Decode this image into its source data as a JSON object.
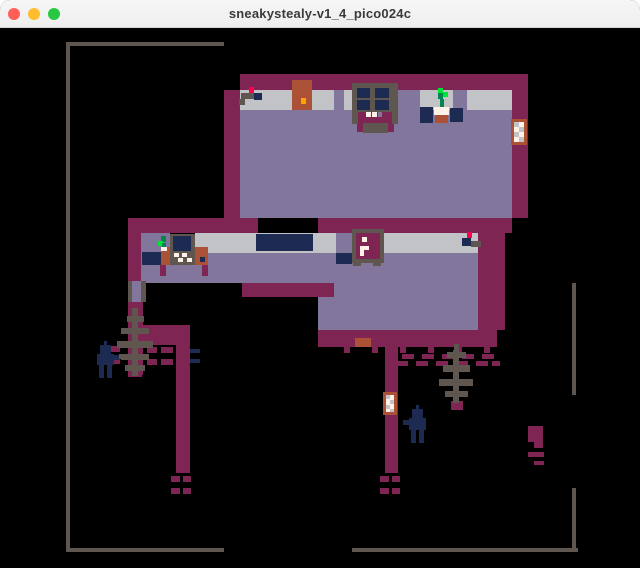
{
  "window": {
    "title": "sneakystealy-v1_4_pico024c",
    "traffic_lights": [
      {
        "name": "close",
        "color": "#FF5F57"
      },
      {
        "name": "minimize",
        "color": "#FEBC2E"
      },
      {
        "name": "zoom",
        "color": "#28C840"
      }
    ]
  },
  "palette": {
    "wall": "#7E2553",
    "floor": "#83769C",
    "band": "#C2C3C7",
    "navy": "#1D2B53",
    "line": "#5F574F",
    "brown": "#AB5236",
    "orange": "#FFA300",
    "red": "#FF004D",
    "white": "#FFF1E8",
    "leaf": "#00E436",
    "leafdark": "#008751"
  },
  "map": {
    "background": "#000000",
    "sprites": [
      [
        "boundary-top-line",
        66,
        42,
        158,
        4,
        "line"
      ],
      [
        "boundary-left-line",
        66,
        42,
        4,
        510,
        "line"
      ],
      [
        "boundary-bottom-left-line",
        66,
        548,
        158,
        4,
        "line"
      ],
      [
        "boundary-bottom-right-line",
        352,
        548,
        226,
        4,
        "line"
      ],
      [
        "boundary-right-upper-line",
        572,
        283,
        4,
        112,
        "line"
      ],
      [
        "boundary-right-lower-line",
        572,
        488,
        4,
        64,
        "line"
      ],
      [
        "top-room-top-wall",
        240,
        74,
        288,
        16,
        "wall"
      ],
      [
        "top-room-left-wall",
        224,
        90,
        16,
        128,
        "wall"
      ],
      [
        "top-room-wall-band",
        240,
        90,
        272,
        20,
        "band"
      ],
      [
        "top-room-floor",
        240,
        110,
        272,
        108,
        "floor"
      ],
      [
        "top-room-right-wall",
        512,
        90,
        16,
        128,
        "wall"
      ],
      [
        "left-room-top-wall",
        128,
        218,
        130,
        15,
        "wall"
      ],
      [
        "top-room-bottom-wall",
        318,
        218,
        194,
        15,
        "wall"
      ],
      [
        "camera1-foot",
        239,
        99,
        6,
        6,
        "line"
      ],
      [
        "camera1-arm",
        241,
        93,
        13,
        6,
        "line"
      ],
      [
        "camera1-body",
        254,
        93,
        8,
        7,
        "navy"
      ],
      [
        "camera1-light",
        249,
        87,
        5,
        6,
        "red"
      ],
      [
        "door1",
        292,
        80,
        20,
        30,
        "brown"
      ],
      [
        "door1-handle",
        301,
        98,
        5,
        6,
        "orange"
      ],
      [
        "band-lavender-patch1",
        334,
        90,
        10,
        20,
        "floor"
      ],
      [
        "band-lavender-patch2",
        398,
        90,
        22,
        20,
        "floor"
      ],
      [
        "band-lavender-patch3",
        453,
        90,
        14,
        20,
        "floor"
      ],
      [
        "kitchen-counter1",
        420,
        107,
        13,
        16,
        "navy"
      ],
      [
        "kitchen-counter2",
        450,
        108,
        13,
        14,
        "navy"
      ],
      [
        "stove-frame",
        352,
        83,
        46,
        30,
        "line"
      ],
      [
        "stove-pane-tl",
        357,
        88,
        13,
        10,
        "navy"
      ],
      [
        "stove-pane-tr",
        375,
        88,
        14,
        10,
        "navy"
      ],
      [
        "stove-pane-bl",
        357,
        100,
        13,
        10,
        "navy"
      ],
      [
        "stove-pane-br",
        375,
        100,
        14,
        10,
        "navy"
      ],
      [
        "stove-hearth",
        352,
        112,
        46,
        12,
        "wall"
      ],
      [
        "stove-shoulder-left",
        352,
        112,
        6,
        12,
        "line"
      ],
      [
        "stove-shoulder-right",
        392,
        112,
        6,
        12,
        "line"
      ],
      [
        "stove-tooth1",
        366,
        112,
        5,
        5,
        "white"
      ],
      [
        "stove-tooth2",
        372,
        112,
        5,
        5,
        "white"
      ],
      [
        "stove-tooth3",
        378,
        112,
        4,
        5,
        "floor"
      ],
      [
        "stove-apron-left",
        357,
        124,
        6,
        8,
        "wall"
      ],
      [
        "stove-apron-right",
        388,
        124,
        6,
        8,
        "wall"
      ],
      [
        "stove-base",
        363,
        123,
        25,
        10,
        "line"
      ],
      [
        "plant1-leaf1",
        438,
        88,
        5,
        5,
        "leaf"
      ],
      [
        "plant1-leaf2",
        443,
        92,
        5,
        5,
        "leaf"
      ],
      [
        "plant1-stem",
        438,
        93,
        5,
        6,
        "leafdark"
      ],
      [
        "plant1-stem2",
        440,
        99,
        4,
        9,
        "leafdark"
      ],
      [
        "plant1-pot-top",
        434,
        107,
        15,
        8,
        "white"
      ],
      [
        "plant1-pot-base",
        435,
        115,
        13,
        8,
        "brown"
      ],
      [
        "ladder1-frame",
        511,
        119,
        16,
        26,
        "brown"
      ],
      [
        "ladder1-inner",
        514,
        122,
        10,
        20,
        "white"
      ],
      [
        "ladder1-check1",
        514,
        122,
        5,
        5,
        "band"
      ],
      [
        "ladder1-check2",
        519,
        127,
        5,
        5,
        "band"
      ],
      [
        "ladder1-check3",
        514,
        132,
        5,
        5,
        "band"
      ],
      [
        "ladder1-check4",
        519,
        137,
        5,
        5,
        "band"
      ],
      [
        "left-room-left-wall",
        128,
        233,
        14,
        48,
        "wall"
      ],
      [
        "mid-wall-band",
        195,
        233,
        283,
        20,
        "band"
      ],
      [
        "left-room-band-floor",
        141,
        233,
        29,
        20,
        "floor"
      ],
      [
        "mid-floor-upper",
        141,
        253,
        337,
        30,
        "floor"
      ],
      [
        "mid-right-wall",
        478,
        233,
        27,
        97,
        "wall"
      ],
      [
        "mid-low-wall",
        242,
        283,
        92,
        14,
        "wall"
      ],
      [
        "mid-floor-right",
        334,
        283,
        144,
        47,
        "floor"
      ],
      [
        "mid-floor-notch",
        318,
        297,
        16,
        33,
        "floor"
      ],
      [
        "mid-bottom-wall",
        318,
        330,
        179,
        17,
        "wall"
      ],
      [
        "bench",
        142,
        252,
        19,
        13,
        "navy"
      ],
      [
        "desk-left",
        161,
        247,
        10,
        18,
        "brown"
      ],
      [
        "desk-right",
        195,
        247,
        13,
        18,
        "brown"
      ],
      [
        "desk-leg-left",
        160,
        265,
        6,
        11,
        "wall"
      ],
      [
        "desk-leg-right",
        202,
        265,
        6,
        11,
        "wall"
      ],
      [
        "monitor-frame",
        170,
        234,
        25,
        31,
        "line"
      ],
      [
        "monitor-screen",
        173,
        236,
        18,
        15,
        "navy"
      ],
      [
        "monitor-key1",
        174,
        253,
        5,
        4,
        "white"
      ],
      [
        "monitor-key2",
        182,
        253,
        5,
        4,
        "white"
      ],
      [
        "monitor-key3",
        178,
        258,
        5,
        4,
        "white"
      ],
      [
        "monitor-key4",
        187,
        258,
        5,
        4,
        "white"
      ],
      [
        "desk-knob",
        200,
        257,
        5,
        5,
        "navy"
      ],
      [
        "plant2-leaf1",
        161,
        236,
        5,
        6,
        "leafdark"
      ],
      [
        "plant2-leaf2",
        158,
        241,
        5,
        5,
        "leaf"
      ],
      [
        "plant2-leaf3",
        162,
        243,
        4,
        5,
        "leafdark"
      ],
      [
        "plant2-pot",
        161,
        247,
        6,
        4,
        "white"
      ],
      [
        "long-counter",
        256,
        234,
        57,
        17,
        "navy"
      ],
      [
        "band-lavender-patch4",
        336,
        233,
        16,
        20,
        "floor"
      ],
      [
        "floor-counter",
        336,
        253,
        16,
        11,
        "navy"
      ],
      [
        "safe-frame",
        352,
        229,
        32,
        34,
        "line"
      ],
      [
        "safe-door",
        356,
        233,
        24,
        26,
        "wall"
      ],
      [
        "safe-dot",
        362,
        237,
        5,
        5,
        "white"
      ],
      [
        "safe-handle-top",
        360,
        246,
        9,
        4,
        "white"
      ],
      [
        "safe-handle-stem",
        360,
        250,
        4,
        6,
        "white"
      ],
      [
        "safe-foot-left",
        353,
        261,
        8,
        5,
        "line"
      ],
      [
        "safe-foot-right",
        373,
        261,
        8,
        5,
        "line"
      ],
      [
        "camera2-light",
        467,
        232,
        5,
        6,
        "red"
      ],
      [
        "camera2-body",
        462,
        238,
        9,
        8,
        "navy"
      ],
      [
        "camera2-arm",
        471,
        241,
        10,
        6,
        "line"
      ],
      [
        "corridor-jamb-left",
        128,
        281,
        4,
        21,
        "line"
      ],
      [
        "corridor-floor",
        132,
        281,
        9,
        21,
        "floor"
      ],
      [
        "corridor-jamb-right",
        141,
        281,
        5,
        21,
        "line"
      ],
      [
        "path-left-upper",
        128,
        302,
        15,
        73,
        "wall"
      ],
      [
        "path-connector",
        143,
        325,
        47,
        20,
        "wall"
      ],
      [
        "path-left-lower",
        176,
        345,
        14,
        128,
        "wall"
      ],
      [
        "path-right",
        385,
        345,
        13,
        128,
        "wall"
      ],
      [
        "door-mat",
        355,
        338,
        16,
        9,
        "brown"
      ],
      [
        "hedge-tooth1",
        344,
        347,
        6,
        6,
        "wall"
      ],
      [
        "hedge-tooth2",
        372,
        347,
        6,
        6,
        "wall"
      ],
      [
        "hedge-tooth3",
        400,
        347,
        6,
        6,
        "wall"
      ],
      [
        "hedge-tooth4",
        428,
        347,
        6,
        6,
        "wall"
      ],
      [
        "hedge-tooth5",
        456,
        347,
        6,
        6,
        "wall"
      ],
      [
        "hedge-tooth6",
        484,
        347,
        6,
        6,
        "wall"
      ],
      [
        "hedge-dash1",
        402,
        354,
        12,
        5,
        "wall"
      ],
      [
        "hedge-dash2",
        422,
        354,
        12,
        5,
        "wall"
      ],
      [
        "hedge-dash3",
        442,
        354,
        12,
        5,
        "wall"
      ],
      [
        "hedge-dash4",
        462,
        354,
        12,
        5,
        "wall"
      ],
      [
        "hedge-dash5",
        482,
        354,
        12,
        5,
        "wall"
      ],
      [
        "hedge-dash6",
        396,
        361,
        12,
        5,
        "wall"
      ],
      [
        "hedge-dash7",
        416,
        361,
        12,
        5,
        "wall"
      ],
      [
        "hedge-dash8",
        436,
        361,
        12,
        5,
        "wall"
      ],
      [
        "hedge-dash9",
        456,
        361,
        12,
        5,
        "wall"
      ],
      [
        "hedge-dash10",
        476,
        361,
        12,
        5,
        "wall"
      ],
      [
        "hedge-dash11",
        492,
        361,
        8,
        5,
        "wall"
      ],
      [
        "fence-l-dash1",
        147,
        347,
        10,
        6,
        "wall"
      ],
      [
        "fence-l-dash2",
        161,
        347,
        12,
        6,
        "wall"
      ],
      [
        "fence-l-dash3",
        190,
        349,
        10,
        4,
        "navy"
      ],
      [
        "fence-l-dash4",
        147,
        359,
        10,
        6,
        "wall"
      ],
      [
        "fence-l-dash5",
        161,
        359,
        12,
        6,
        "wall"
      ],
      [
        "fence-l-dash6",
        190,
        359,
        10,
        4,
        "navy"
      ],
      [
        "fence-l-dash7",
        110,
        346,
        10,
        6,
        "wall"
      ],
      [
        "fence-l-dash8",
        112,
        358,
        8,
        6,
        "wall"
      ],
      [
        "path-left-end-dash1",
        171,
        476,
        9,
        6,
        "wall"
      ],
      [
        "path-left-end-dash2",
        183,
        476,
        8,
        6,
        "wall"
      ],
      [
        "path-left-end-dash3",
        171,
        488,
        9,
        6,
        "wall"
      ],
      [
        "path-left-end-dash4",
        183,
        488,
        8,
        6,
        "wall"
      ],
      [
        "path-right-end-dash1",
        380,
        476,
        9,
        6,
        "wall"
      ],
      [
        "path-right-end-dash2",
        392,
        476,
        8,
        6,
        "wall"
      ],
      [
        "path-right-end-dash3",
        380,
        488,
        9,
        6,
        "wall"
      ],
      [
        "path-right-end-dash4",
        392,
        488,
        8,
        6,
        "wall"
      ],
      [
        "ladder2-frame",
        383,
        392,
        14,
        23,
        "brown"
      ],
      [
        "ladder2-inner",
        386,
        395,
        8,
        17,
        "white"
      ],
      [
        "ladder2-check1",
        386,
        395,
        4,
        4,
        "band"
      ],
      [
        "ladder2-check2",
        390,
        400,
        4,
        4,
        "band"
      ],
      [
        "ladder2-check3",
        386,
        405,
        4,
        4,
        "band"
      ],
      [
        "ladder2-check4",
        390,
        409,
        4,
        3,
        "band"
      ],
      [
        "tree2-base",
        451,
        401,
        12,
        9,
        "wall"
      ],
      [
        "tree2-tip",
        454,
        344,
        5,
        7,
        "line"
      ],
      [
        "tree2-branch1",
        447,
        352,
        19,
        6,
        "line"
      ],
      [
        "tree2-branch2",
        443,
        365,
        27,
        7,
        "line"
      ],
      [
        "tree2-branch3",
        439,
        379,
        34,
        7,
        "line"
      ],
      [
        "tree2-branch4",
        445,
        391,
        23,
        6,
        "line"
      ],
      [
        "tree2-trunk",
        453,
        350,
        6,
        53,
        "line"
      ],
      [
        "guard2-antenna",
        416,
        405,
        3,
        5,
        "navy"
      ],
      [
        "guard2-head",
        412,
        409,
        11,
        9,
        "navy"
      ],
      [
        "guard2-body",
        409,
        418,
        17,
        12,
        "navy"
      ],
      [
        "guard2-arm",
        403,
        420,
        7,
        5,
        "navy"
      ],
      [
        "guard2-leg-left",
        411,
        430,
        5,
        13,
        "navy"
      ],
      [
        "guard2-leg-right",
        419,
        430,
        5,
        13,
        "navy"
      ],
      [
        "tree1-base",
        128,
        368,
        14,
        9,
        "wall"
      ],
      [
        "tree1-tip",
        133,
        308,
        5,
        8,
        "line"
      ],
      [
        "tree1-branch1",
        127,
        316,
        17,
        6,
        "line"
      ],
      [
        "tree1-branch2",
        121,
        328,
        28,
        6,
        "line"
      ],
      [
        "tree1-branch3",
        117,
        341,
        36,
        7,
        "line"
      ],
      [
        "tree1-branch4",
        121,
        354,
        28,
        6,
        "line"
      ],
      [
        "tree1-branch5",
        125,
        365,
        20,
        6,
        "line"
      ],
      [
        "tree1-trunk",
        132,
        308,
        6,
        68,
        "line"
      ],
      [
        "guard1-antenna",
        104,
        341,
        3,
        5,
        "navy"
      ],
      [
        "guard1-head",
        100,
        345,
        11,
        9,
        "navy"
      ],
      [
        "guard1-body",
        97,
        354,
        17,
        11,
        "navy"
      ],
      [
        "guard1-arm",
        114,
        355,
        6,
        5,
        "navy"
      ],
      [
        "guard1-hand",
        119,
        354,
        4,
        5,
        "line"
      ],
      [
        "guard1-leg-left",
        99,
        365,
        5,
        13,
        "navy"
      ],
      [
        "guard1-leg-right",
        107,
        365,
        5,
        13,
        "navy"
      ],
      [
        "hut-block",
        528,
        426,
        15,
        16,
        "wall"
      ],
      [
        "hut-tail",
        534,
        442,
        9,
        6,
        "wall"
      ],
      [
        "hut-dash1",
        528,
        452,
        16,
        5,
        "wall"
      ],
      [
        "hut-dash2",
        534,
        461,
        10,
        4,
        "wall"
      ]
    ]
  }
}
